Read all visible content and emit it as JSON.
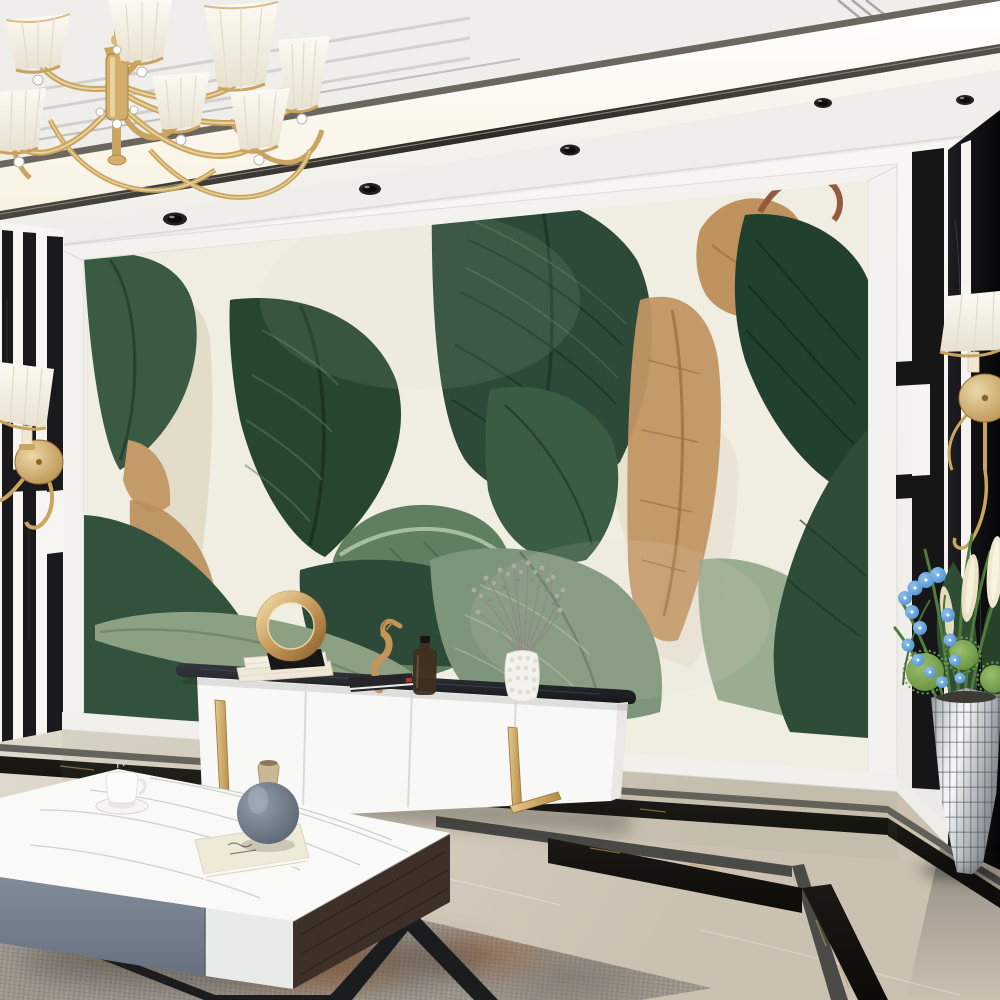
{
  "scene": {
    "label": "modern-living-room-with-tropical-leaf-mural",
    "style": "luxury-interior-render"
  },
  "palette": {
    "ceiling": "#EFEEEA",
    "cove_light": "#FFFDF2",
    "trim_dark": "#3E3B36",
    "wall_white": "#F7F6F3",
    "black_marble": "#121214",
    "gold": "#C9A35F",
    "mural_background": "#F0EDE3",
    "leaf_dark_green": "#24402F",
    "leaf_mid_green": "#3F6047",
    "leaf_sage": "#7D957B",
    "leaf_dried_brown": "#C29663",
    "cabinet_white": "#F8F8F6",
    "cabinet_top_stone": "#23262B",
    "coffee_table_gray": "#78828F",
    "coffee_table_wood": "#3C3028",
    "floor_beige_marble": "#D8D0C3",
    "floor_inlay_black": "#17140F",
    "rug_rust": "#B06A3D",
    "round_vase_blue_gray": "#6E7A85",
    "orchid_blue": "#5A9AD8",
    "planter_silver": "#C9CDCF"
  },
  "counts": {
    "chandelier_shades": 7,
    "ceiling_spotlights": 6,
    "cabinet_drawers": 4,
    "wall_sconces": 2
  },
  "objects": {
    "chandelier": {
      "name": "gold-crystal-chandelier-with-white-pleated-shades"
    },
    "mural": {
      "name": "watercolor-banana-leaf-wallpaper-mural"
    },
    "left_pilaster": {
      "name": "white-pilaster-with-black-marble-stripes"
    },
    "right_column": {
      "name": "black-marble-column-with-white-stripe"
    },
    "left_sconce": {
      "name": "gold-wall-sconce-white-shade"
    },
    "right_sconce": {
      "name": "gold-wall-sconce-white-shade"
    },
    "tv_cabinet": {
      "name": "white-media-cabinet-dark-stone-top-gold-legs"
    },
    "cabinet_decor": [
      "cream-books",
      "gold-ring-sculpture",
      "gold-seahorse-figurine",
      "dark-book-stack",
      "amber-glass-bottle",
      "white-textured-vase-with-dried-gray-flowers"
    ],
    "coffee_table": {
      "name": "white-marble-coffee-table-gray-drawer-wood-side"
    },
    "table_decor": [
      "white-teacup-on-saucer",
      "cream-book",
      "blue-gray-round-vase"
    ],
    "rug": {
      "name": "gray-rust-area-rug"
    },
    "floor_vase": {
      "name": "silver-mosaic-floor-vase"
    },
    "floor_plants": [
      "green-grasses",
      "blue-orchids",
      "green-spike-balls",
      "cream-plumes"
    ],
    "floor": {
      "name": "beige-marble-floor-with-black-gold-inlay-borders"
    }
  }
}
